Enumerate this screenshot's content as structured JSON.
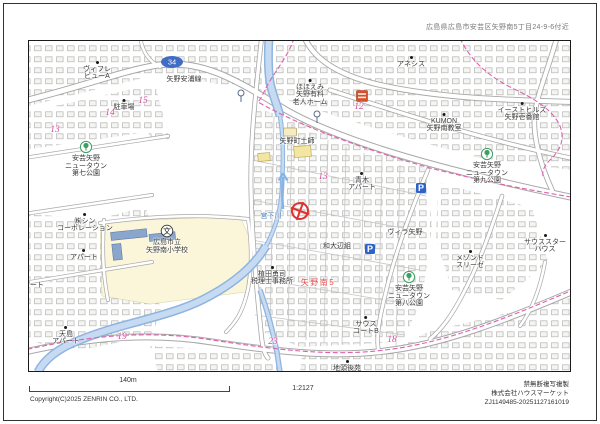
{
  "header": {
    "address": "広島県広島市安芸区矢野南5丁目24-9-6付近"
  },
  "footer": {
    "scale_label": "140m",
    "ratio": "1:2127",
    "copyright": "Copyright(C)2025 ZENRIN CO., LTD.",
    "notice": "禁無断複写複製",
    "company": "株式会社ハウスマーケット",
    "serial": "ZJ1149485-20251127161019"
  },
  "palette": {
    "block_number_pink": "#d44f9e",
    "town_red": "#e34b4b",
    "water_blue": "#8fb4df",
    "boundary_magenta": "#e060ae",
    "park_green": "#3f9e63",
    "parking_blue": "#2e62c8",
    "store_orange": "#d8502a",
    "target_red": "#e03030",
    "road_gray": "#a8a8a8"
  },
  "map": {
    "labels": [
      {
        "t": "矢野安浦線",
        "x": 184,
        "y": 76,
        "c": "nm"
      },
      {
        "t": "ほほえみ\n矢野有料\n老人ホーム",
        "x": 310,
        "y": 79,
        "c": "nm",
        "dot": 1
      },
      {
        "t": "アネシス",
        "x": 411,
        "y": 56,
        "c": "nm",
        "dot": 1
      },
      {
        "t": "イーストヒルズ\n矢野壱番館",
        "x": 522,
        "y": 102,
        "c": "nm",
        "dot": 1
      },
      {
        "t": "KUMON\n矢野南教室",
        "x": 444,
        "y": 113,
        "c": "nm",
        "dot": 1
      },
      {
        "t": "12",
        "x": 359,
        "y": 104,
        "c": "pk"
      },
      {
        "t": "ヴィフレ\nビューA",
        "x": 97,
        "y": 61,
        "c": "nm",
        "dot": 1
      },
      {
        "t": "駐車場",
        "x": 124,
        "y": 99,
        "c": "nm",
        "dot": 1
      },
      {
        "t": "15",
        "x": 143,
        "y": 98,
        "c": "pk"
      },
      {
        "t": "14",
        "x": 110,
        "y": 110,
        "c": "pk"
      },
      {
        "t": "13",
        "x": 55,
        "y": 127,
        "c": "pk"
      },
      {
        "t": "安芸矢野\nニュータウン\n第七公園",
        "x": 86,
        "y": 155,
        "c": "nm"
      },
      {
        "t": "㈱シン\nコーポレーション",
        "x": 85,
        "y": 213,
        "c": "nm",
        "dot": 1
      },
      {
        "t": "アパート",
        "x": 84,
        "y": 249,
        "c": "nm",
        "dot": 1
      },
      {
        "t": "アパート",
        "x": 30,
        "y": 282,
        "c": "nm"
      },
      {
        "t": "天島\nアパート",
        "x": 66,
        "y": 326,
        "c": "nm",
        "dot": 1
      },
      {
        "t": "19",
        "x": 122,
        "y": 334,
        "c": "pk"
      },
      {
        "t": "広島市立\n矢野南小学校",
        "x": 167,
        "y": 239,
        "c": "nm"
      },
      {
        "t": "宮下川",
        "x": 271,
        "y": 213,
        "c": "wt"
      },
      {
        "t": "矢野町土師",
        "x": 297,
        "y": 138,
        "c": "nm"
      },
      {
        "t": "13",
        "x": 323,
        "y": 174,
        "c": "pk"
      },
      {
        "t": "青木\nアパート",
        "x": 362,
        "y": 172,
        "c": "nm",
        "dot": 1
      },
      {
        "t": "和大辺組",
        "x": 337,
        "y": 243,
        "c": "nm"
      },
      {
        "t": "ヴィラ矢野",
        "x": 405,
        "y": 229,
        "c": "nm"
      },
      {
        "t": "メゾンド\nスリーゼ",
        "x": 470,
        "y": 250,
        "c": "nm",
        "dot": 1
      },
      {
        "t": "安芸矢野\nニュータウン\n第八公園",
        "x": 409,
        "y": 285,
        "c": "nm"
      },
      {
        "t": "安芸矢野\nニュータウン\n第九公園",
        "x": 487,
        "y": 162,
        "c": "nm"
      },
      {
        "t": "サウススター\nハウス",
        "x": 545,
        "y": 234,
        "c": "nm",
        "dot": 1
      },
      {
        "t": "サウス\nコートB",
        "x": 366,
        "y": 316,
        "c": "nm",
        "dot": 1
      },
      {
        "t": "矢野南5",
        "x": 318,
        "y": 279,
        "c": "rd"
      },
      {
        "t": "23",
        "x": 273,
        "y": 339,
        "c": "pk"
      },
      {
        "t": "18",
        "x": 392,
        "y": 337,
        "c": "pk"
      },
      {
        "t": "植田勇司\n税理士事務所",
        "x": 272,
        "y": 266,
        "c": "nm",
        "dot": 1
      },
      {
        "t": "地頭後苑\nデイサービスセンター",
        "x": 347,
        "y": 360,
        "c": "nm",
        "dot": 1
      }
    ],
    "icons": [
      {
        "type": "route-badge",
        "x": 172,
        "y": 62,
        "text": "34"
      },
      {
        "type": "park",
        "x": 86,
        "y": 147
      },
      {
        "type": "park",
        "x": 487,
        "y": 154
      },
      {
        "type": "park",
        "x": 409,
        "y": 277
      },
      {
        "type": "school",
        "x": 167,
        "y": 231
      },
      {
        "type": "parking",
        "x": 421,
        "y": 188
      },
      {
        "type": "parking",
        "x": 370,
        "y": 249
      },
      {
        "type": "store",
        "x": 362,
        "y": 96
      },
      {
        "type": "target",
        "x": 300,
        "y": 211
      },
      {
        "type": "busstop",
        "x": 241,
        "y": 96
      },
      {
        "type": "busstop",
        "x": 317,
        "y": 117
      },
      {
        "type": "flow-arrow",
        "x": 283,
        "y": 190
      },
      {
        "type": "badge-haji",
        "x": 290,
        "y": 132
      }
    ]
  }
}
